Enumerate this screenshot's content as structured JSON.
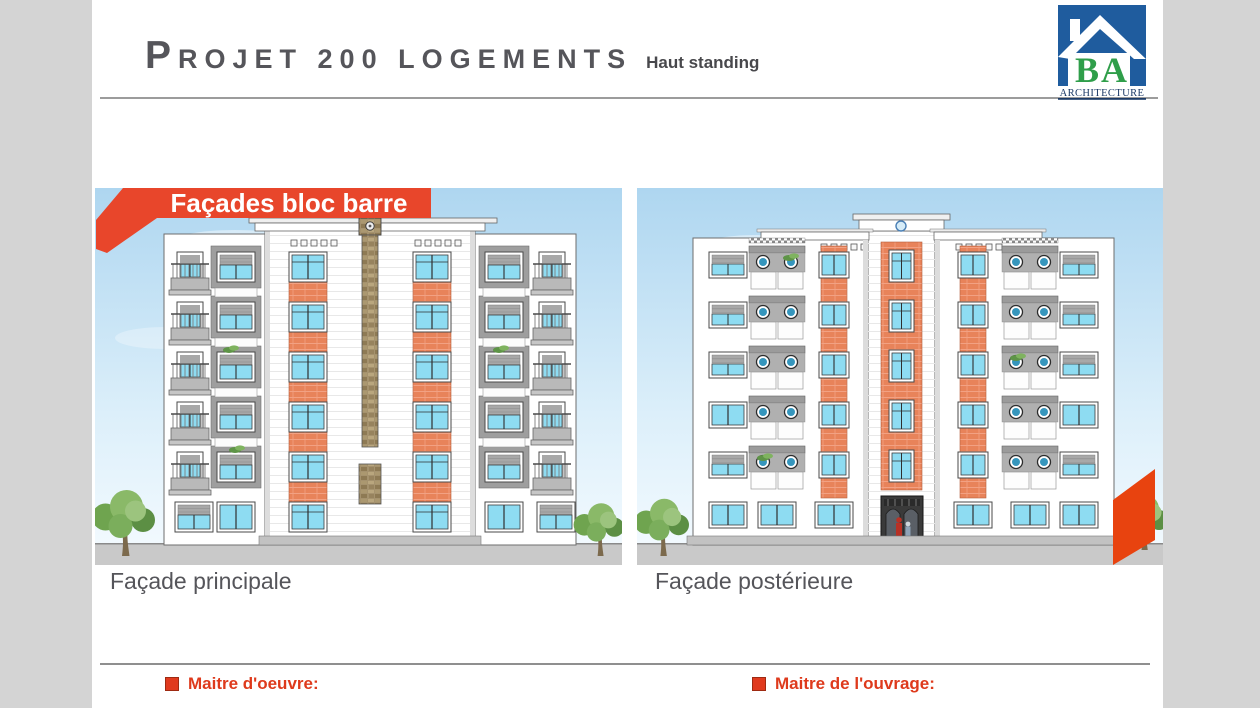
{
  "header": {
    "title": "Projet 200 logements",
    "subtitle": "Haut standing"
  },
  "logo": {
    "initials": "BA",
    "name": "ARCHITECTURE"
  },
  "banner": {
    "label": "Façades bloc barre"
  },
  "figures": [
    {
      "caption": "Façade principale"
    },
    {
      "caption": "Façade postérieure"
    }
  ],
  "footer": {
    "items": [
      {
        "label": "Maitre d'oeuvre:"
      },
      {
        "label": "Maitre de l'ouvrage:"
      }
    ]
  },
  "colors": {
    "accent_red": "#e8462b",
    "footer_red": "#de3a1c",
    "brick_orange": "#e8835a",
    "glass_blue": "#8edcf2",
    "porthole_teal": "#3596bd",
    "sky_blue": "#aed6f0",
    "ground_gray": "#c9c9c9",
    "logo_blue": "#1f5c9e",
    "logo_green": "#2f9e4a",
    "title_gray": "#55555a",
    "side_band_gray": "#d4d4d4"
  }
}
